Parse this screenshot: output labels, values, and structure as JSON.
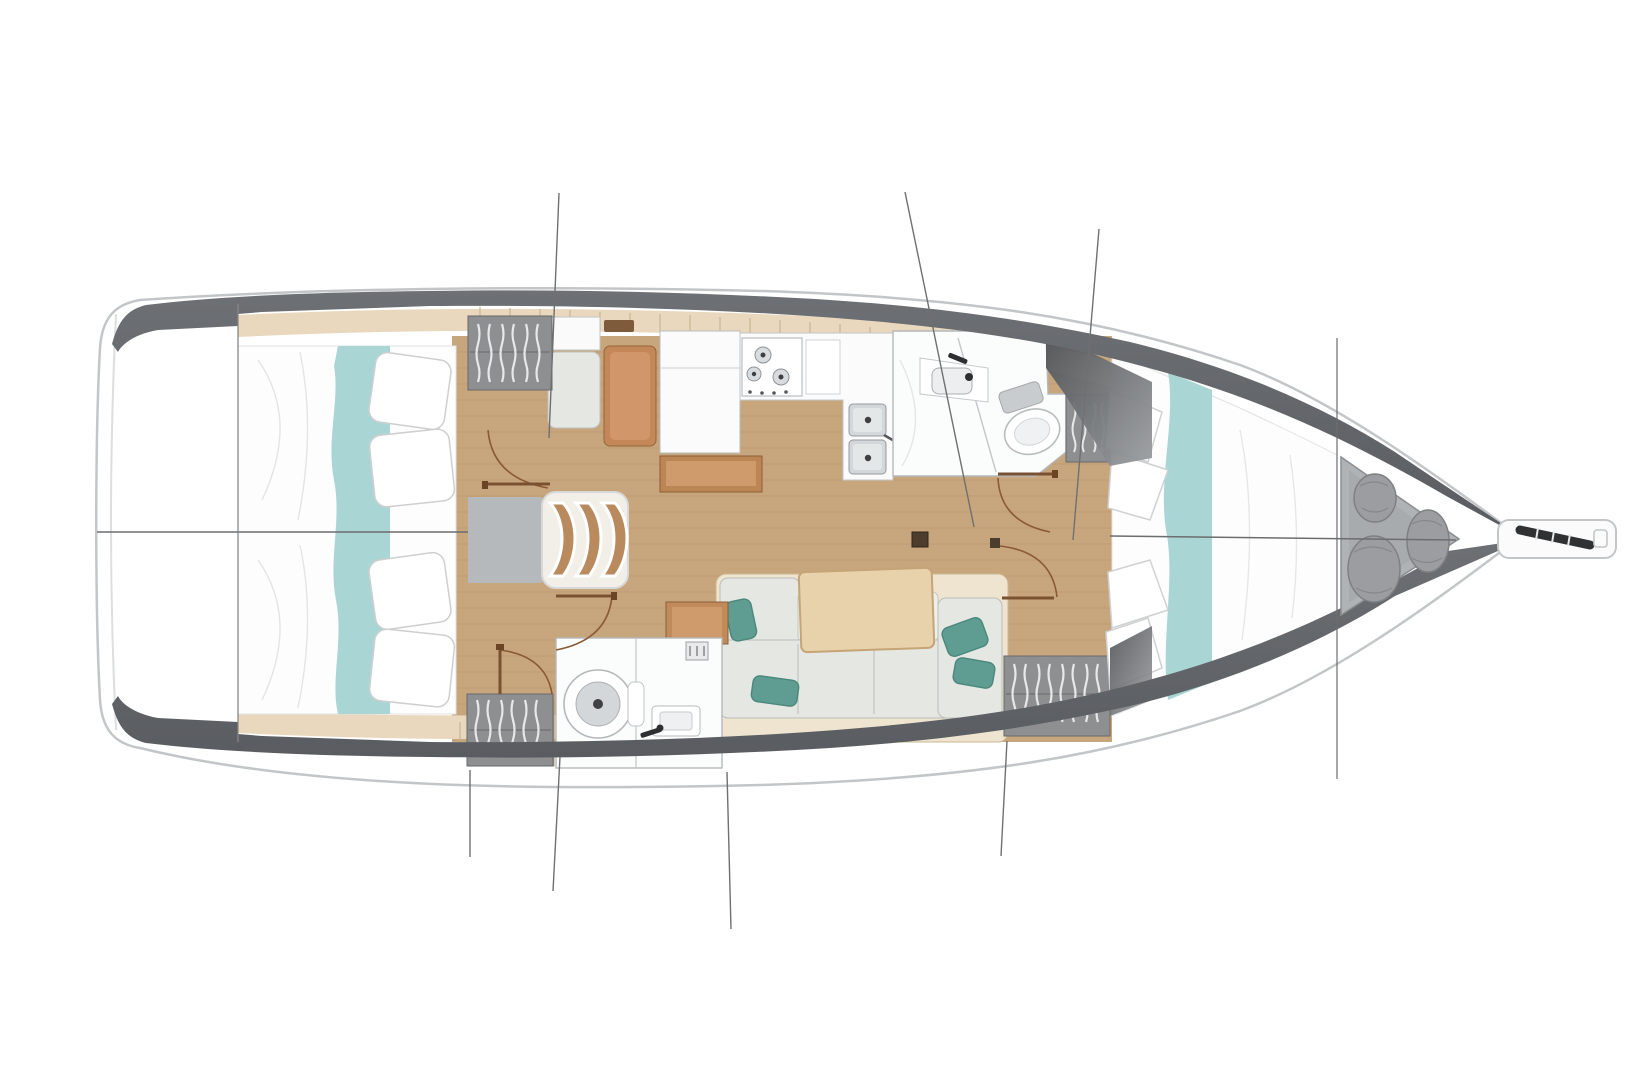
{
  "meta": {
    "type": "floorplan-diagram",
    "subject": "sailboat-interior-layout-top-view",
    "orientation": "bow-right-stern-left"
  },
  "palette": {
    "page_bg": "#ffffff",
    "hull_fill": "#ffffff",
    "hull_outline": "#c3c6c8",
    "deck_band": "#63666a",
    "wood_floor": "#c8a67d",
    "wood_trim": "#e9d8be",
    "wood_tick": "#c9b493",
    "locker_gray": "#8d8f91",
    "locker_edge": "#66686a",
    "hanger_white": "#e8e8e8",
    "bed_white": "#fdfdfd",
    "bed_stroke": "#cfcfcf",
    "teal_runner": "#a9d5d4",
    "teal_pillow": "#5f9c91",
    "teal_pillow_edge": "#4a877c",
    "cushion": "#e5e7e3",
    "cushion_light": "#edefeb",
    "cushion_edge": "#b9bdb8",
    "sofa_base": "#efe4d0",
    "sofa_base_edge": "#cbb794",
    "bench_orange": "#c48757",
    "bench_orange_light": "#d2966b",
    "bench_orange_edge": "#96653a",
    "table_wood": "#e8d2ac",
    "table_edge": "#c5a476",
    "counter_white": "#fbfbfb",
    "counter_edge": "#c2c5c7",
    "steel": "#d3d7d9",
    "steel_edge": "#94989b",
    "engine_gray": "#b6b9bb",
    "engine_edge": "#96999b",
    "steps_tread": "#b98a5e",
    "anchor_locker": "#b0b3b5",
    "anchor_locker_edge": "#8b8e90",
    "bag_gray": "#9b9da0",
    "bag_edge": "#7e8184",
    "door_arc": "#8a5a33",
    "door_leaf": "#7a5130",
    "construction_line": "#6b6d6f",
    "rigging_line": "#6e7072",
    "dark_fitting": "#2f3133",
    "mast_block": "#4c3d2c"
  },
  "inventory": {
    "aft_cabins": 2,
    "aft_cabin_features": [
      "double-berth",
      "teal-runner",
      "two-pillows",
      "hanging-locker"
    ],
    "forward_cabin_features": [
      "v-berth",
      "teal-runner",
      "pillows",
      "two-hanging-lockers"
    ],
    "heads": 2,
    "head_features": [
      "toilet",
      "sink",
      "shower",
      "door-arc"
    ],
    "galley_features": [
      "three-burner-stove",
      "double-sink",
      "counters"
    ],
    "nav_station_features": [
      "seat",
      "bench",
      "chart-table",
      "shelf"
    ],
    "salon_features": [
      "c-shaped-settee",
      "wood-table",
      "teal-throw-pillows",
      "mast-step"
    ],
    "companionway_features": [
      "engine-box",
      "three-curved-steps"
    ],
    "bow_features": [
      "anchor-locker",
      "fender-bags",
      "bowsprit",
      "anchor-roller"
    ],
    "stove_burners": 3,
    "companionway_steps": 3,
    "fender_bags": 3,
    "door_arcs": 5,
    "rigging_lines": 8
  }
}
